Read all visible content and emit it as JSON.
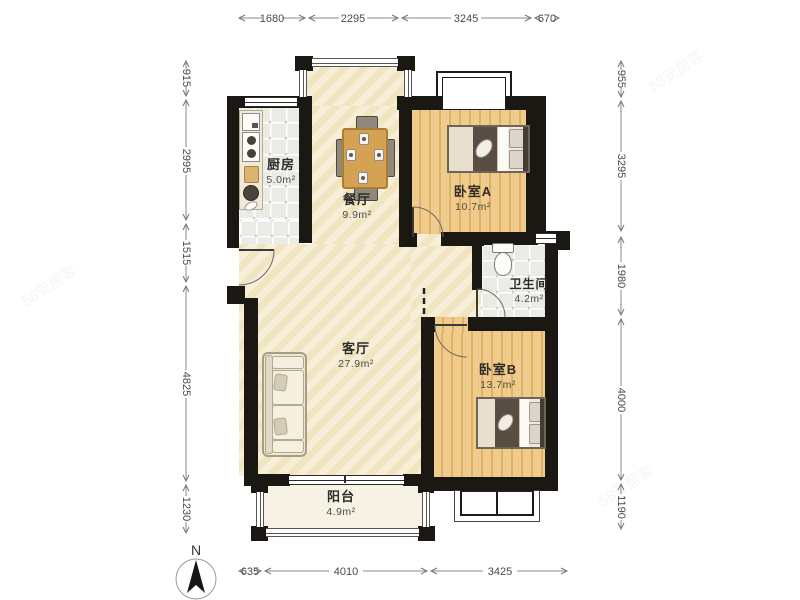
{
  "floorplan": {
    "rooms": {
      "kitchen": {
        "name": "厨房",
        "area": "5.0m²"
      },
      "dining": {
        "name": "餐厅",
        "area": "9.9m²"
      },
      "bedroom_a": {
        "name": "卧室A",
        "area": "10.7m²"
      },
      "bathroom": {
        "name": "卫生间",
        "area": "4.2m²"
      },
      "living": {
        "name": "客厅",
        "area": "27.9m²"
      },
      "bedroom_b": {
        "name": "卧室B",
        "area": "13.7m²"
      },
      "balcony": {
        "name": "阳台",
        "area": "4.9m²"
      }
    },
    "dimensions_mm": {
      "top": [
        "1680",
        "2295",
        "3245",
        "670"
      ],
      "left": [
        "915",
        "2995",
        "1515",
        "4825",
        "1230"
      ],
      "right": [
        "955",
        "3295",
        "1980",
        "4000",
        "1190"
      ],
      "bottom": [
        "635",
        "4010",
        "3425"
      ]
    },
    "compass": {
      "label": "N"
    },
    "watermark": "58安居客",
    "colors": {
      "wall": "#1b1712",
      "wood_floor": "#e9c17b",
      "tile_floor": "#ebebe6",
      "living_floor": "#f5ebd0",
      "balcony_floor": "#f7f3e4",
      "dim_text": "#4a4a4a"
    }
  }
}
